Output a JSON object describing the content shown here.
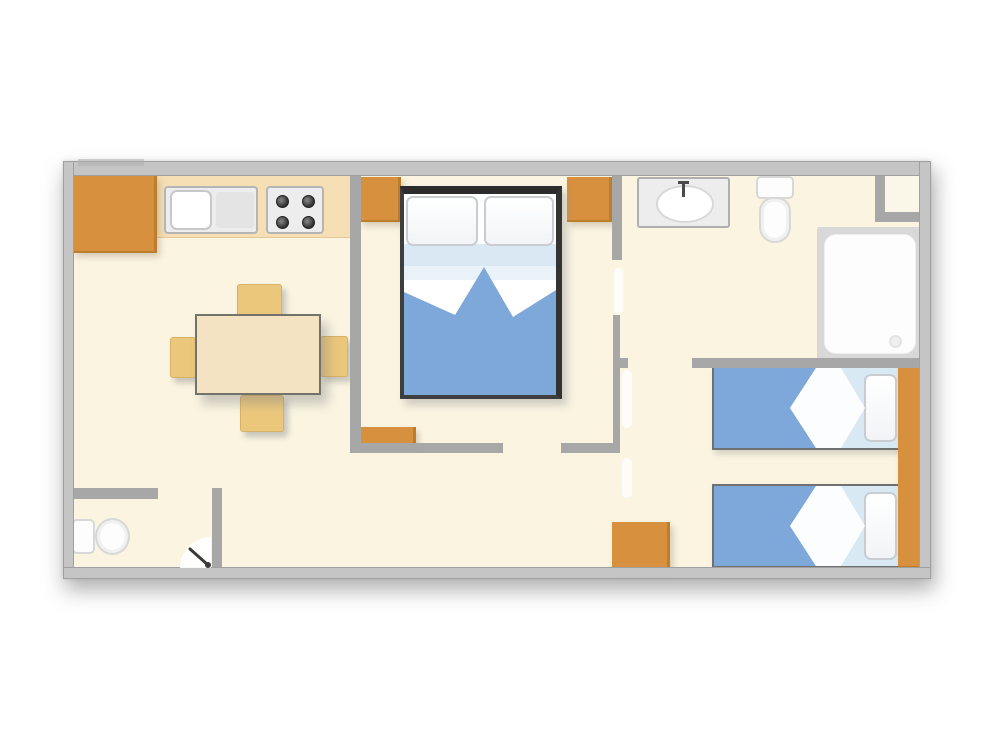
{
  "app": {
    "type": "floor-plan-image"
  },
  "colors": {
    "page_bg": "#FFFFFF",
    "floor": "#FAF4E1",
    "niche_floor": "#FBF7E8",
    "outer_wall": "#C5C5C5",
    "inner_wall": "#A7A7A7",
    "wall_edge": "#A0A0A0",
    "cabinet_orange": "#D7913E",
    "cabinet_orange_dark": "#BC7D2D",
    "counter_tan": "#F6DFB4",
    "chair_tan": "#EBC77C",
    "table_tan": "#F3E3C3",
    "table_border": "#73736B",
    "appliance_gray": "#EDEDED",
    "appliance_border": "#B5B5B5",
    "burner_dark": "#323232",
    "bed_frame_dark": "#2C2C2C",
    "blanket_blue": "#7EA7DA",
    "sheet_pale_blue": "#DAE8F4",
    "sheet_pale_blue_2": "#EAF2F9",
    "single_bed_base": "#D9E9F4",
    "fold_white": "#FBFDFE",
    "fixture_white": "#FDFDFD",
    "fixture_border": "#D8D8D8",
    "shower_gray": "#D8D8D8",
    "drain_gray": "#EFEFEF",
    "door_leaf_dark": "#3A3A3A"
  },
  "rooms": [
    {
      "name": "kitchen-living-room",
      "fixtures": [
        "refrigerator-cabinet",
        "kitchen-counter",
        "sink-unit",
        "stove-4-burners",
        "dining-table",
        "dining-chair x4"
      ]
    },
    {
      "name": "master-bedroom",
      "fixtures": [
        "double-bed",
        "pillow x2",
        "wardrobe-cabinet x3"
      ]
    },
    {
      "name": "bathroom",
      "fixtures": [
        "washbasin",
        "toilet",
        "shower-tray",
        "corner-niche"
      ]
    },
    {
      "name": "twin-bedroom",
      "fixtures": [
        "single-bed x2",
        "pillow x2",
        "wardrobe-strip",
        "storage-cabinet"
      ]
    },
    {
      "name": "wc",
      "fixtures": [
        "toilet",
        "door-swing"
      ]
    }
  ]
}
